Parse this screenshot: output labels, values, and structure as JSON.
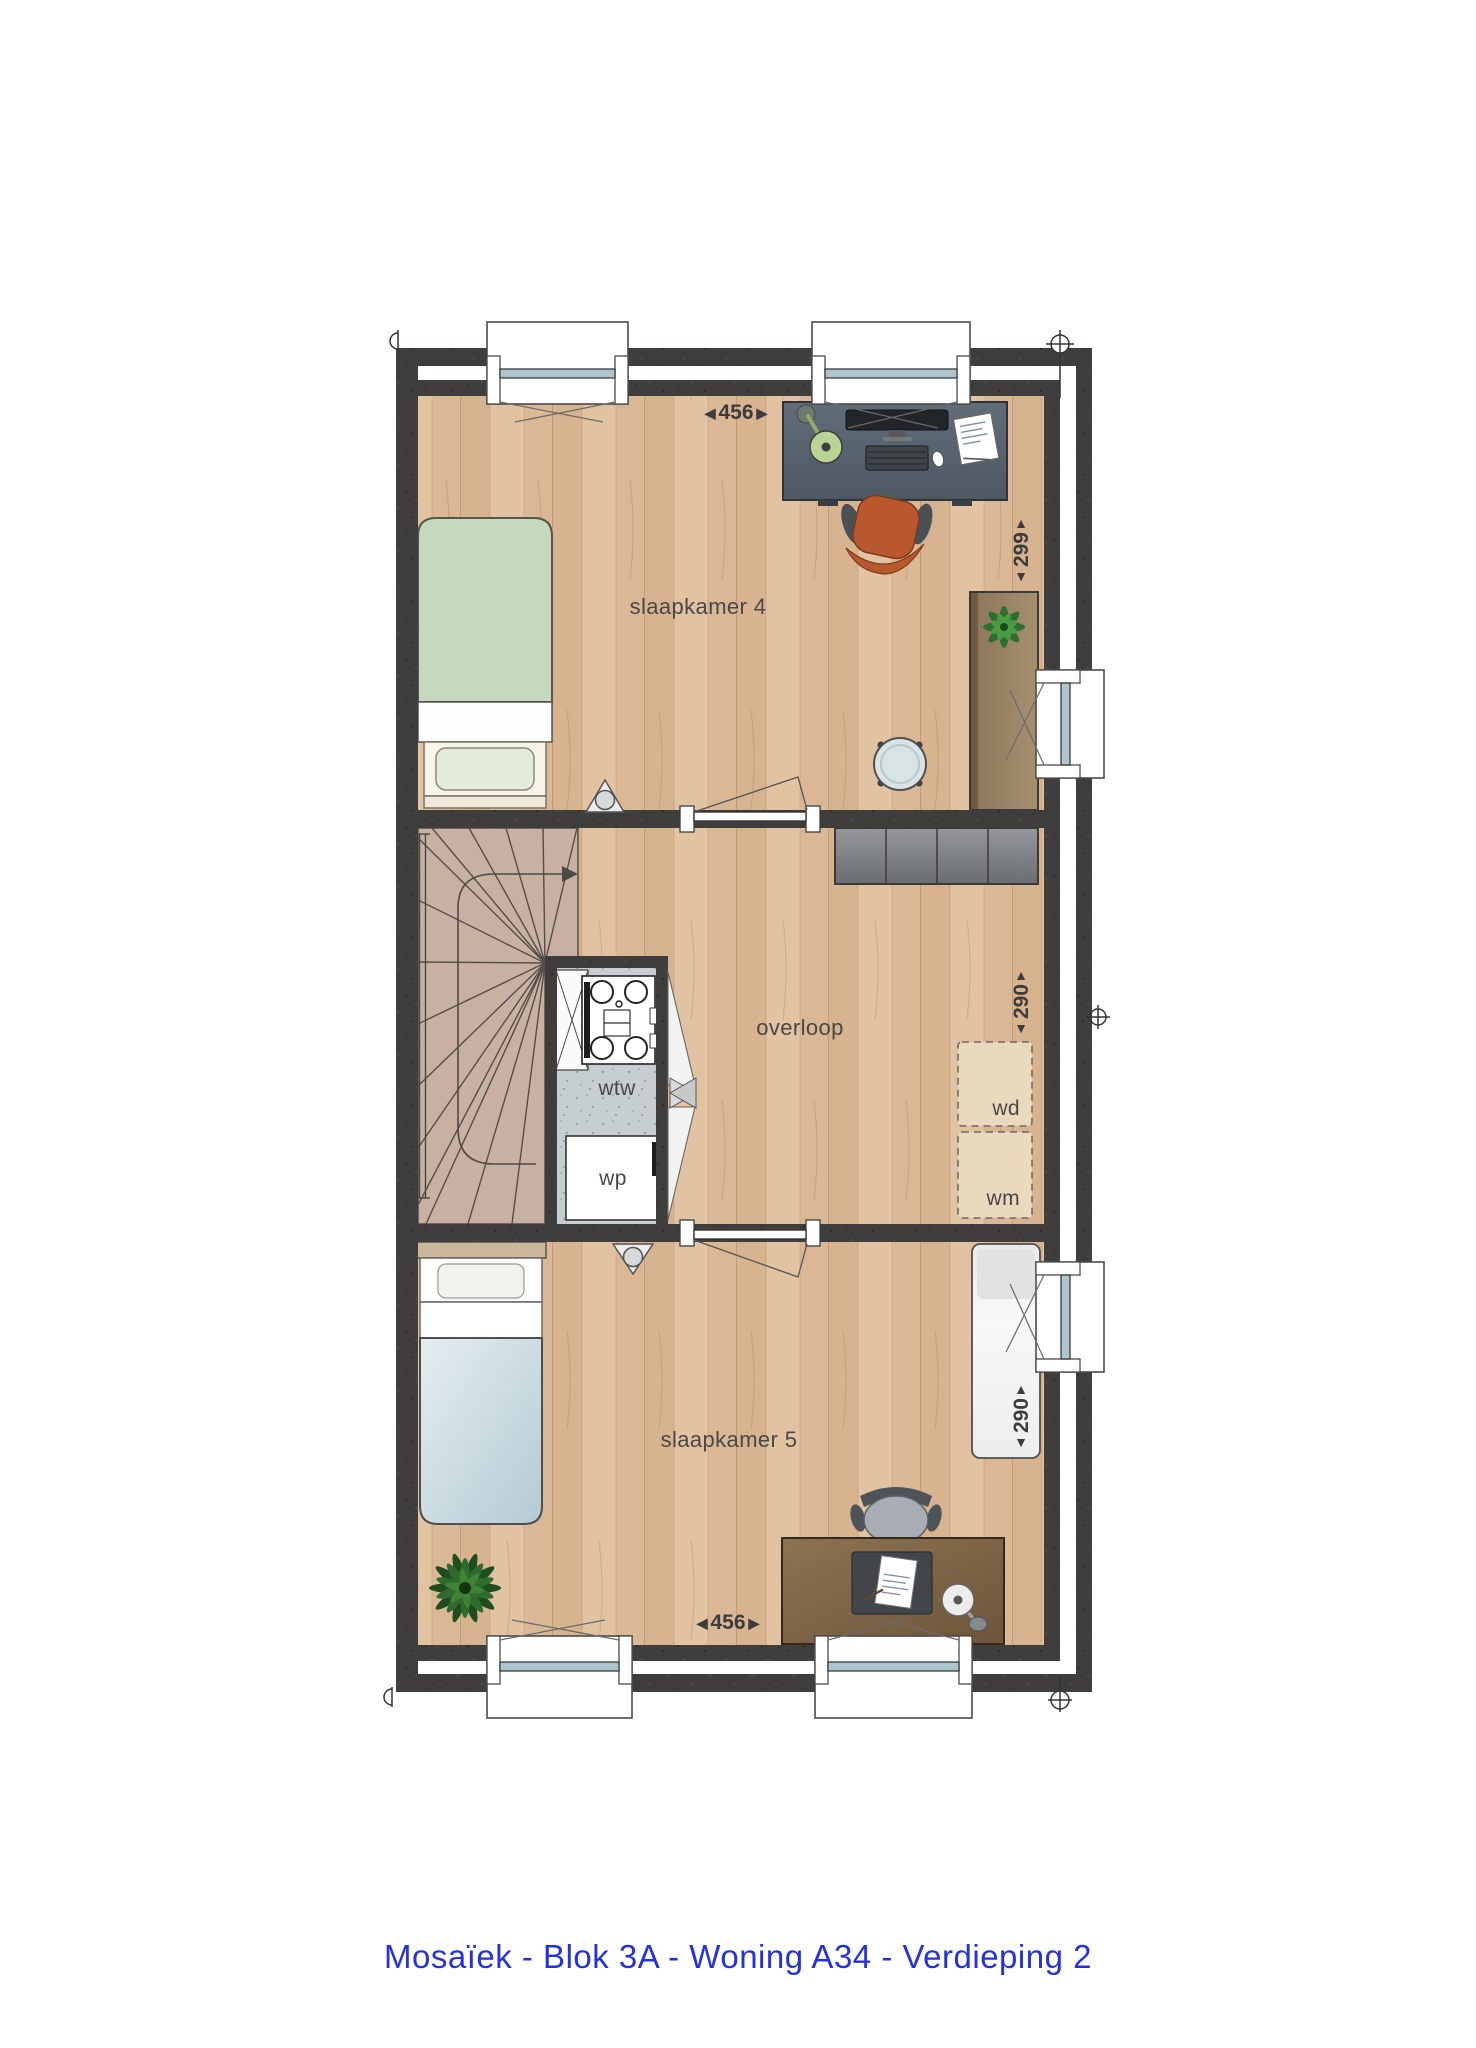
{
  "caption": {
    "text": "Mosaïek - Blok 3A - Woning A34 - Verdieping 2",
    "color": "#2531e0"
  },
  "rooms": {
    "bedroom4": "slaapkamer 4",
    "landing": "overloop",
    "bedroom5": "slaapkamer 5"
  },
  "equipment": {
    "heat_recovery": "wtw",
    "heat_pump": "wp",
    "dryer": "wd",
    "washer": "wm"
  },
  "dimensions_cm": {
    "bedroom4_width": "456",
    "bedroom4_depth": "299",
    "landing_depth": "290",
    "bedroom5_depth": "290",
    "bedroom5_width": "456"
  },
  "icons": {
    "arrow_left": "◀",
    "arrow_right": "▶",
    "arrow_up": "▲",
    "arrow_down": "▼"
  },
  "colors": {
    "wall": "#3f3e3d",
    "floor_wood": "#dcbc9a",
    "stairs": "#c8b1a3",
    "closet_floor": "#c7ced2",
    "cabinet_grey": "#7d8084",
    "bed4_green": "#c6d8bd",
    "bed5_blue": "#cfdfe6",
    "desk_slate": "#5b6672",
    "chair_orange": "#b9572f",
    "caption_blue": "#2531e0"
  }
}
